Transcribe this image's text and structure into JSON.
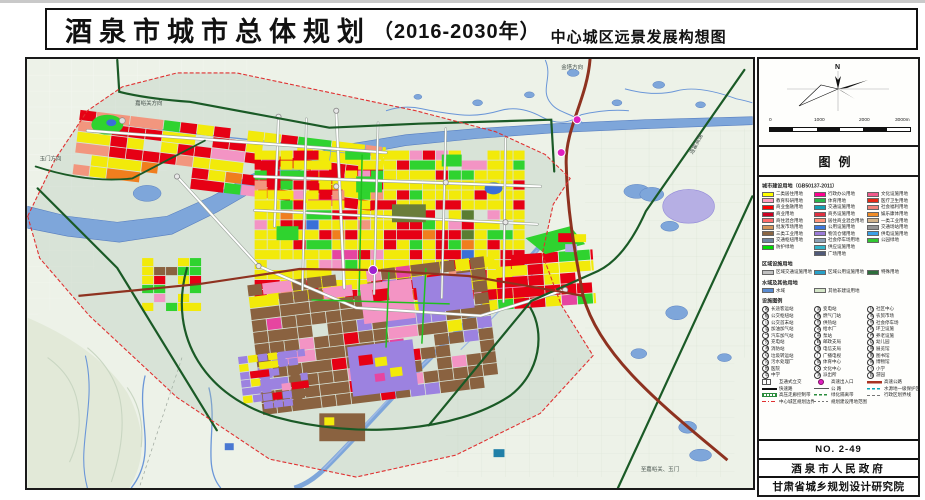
{
  "title": {
    "main": "酒泉市城市总体规划",
    "year": "（2016-2030年）",
    "subtitle": "中心城区远景发展构想图"
  },
  "sidebar": {
    "compass_north": "N",
    "scale": {
      "ticks": [
        "0",
        "1000",
        "2000",
        "3000m"
      ]
    },
    "legend_title": "图例",
    "landuse": {
      "header": "城市建设用地（GB50137-2011）",
      "columns": [
        [
          {
            "label": "二类居住用地",
            "color": "#ffff00"
          },
          {
            "label": "教育科研用地",
            "color": "#ff9dbe"
          },
          {
            "label": "商业金融用地",
            "color": "#ff0000"
          },
          {
            "label": "商业用地",
            "color": "#cc0022"
          },
          {
            "label": "商住混合用地",
            "color": "#ff6a6a"
          },
          {
            "label": "批发市场用地",
            "color": "#d2945a"
          },
          {
            "label": "三类工业用地",
            "color": "#8a6642"
          },
          {
            "label": "交通枢纽用地",
            "color": "#6e86a0"
          },
          {
            "label": "防护绿地",
            "color": "#00dc00"
          }
        ],
        [
          {
            "label": "行政办公用地",
            "color": "#ff0090"
          },
          {
            "label": "体育用地",
            "color": "#2ab54a"
          },
          {
            "label": "交通设施用地",
            "color": "#14a0b4"
          },
          {
            "label": "商务设施用地",
            "color": "#e03040"
          },
          {
            "label": "居住商业混合用地",
            "color": "#ff9478"
          },
          {
            "label": "公用设施用地",
            "color": "#3c78dc"
          },
          {
            "label": "物流仓储用地",
            "color": "#9b7bd8"
          },
          {
            "label": "社会停车场用地",
            "color": "#8ca0b4"
          },
          {
            "label": "供应设施用地",
            "color": "#32b4c8"
          },
          {
            "label": "广场用地",
            "color": "#505a78"
          }
        ],
        [
          {
            "label": "文化设施用地",
            "color": "#f05a8c"
          },
          {
            "label": "医疗卫生用地",
            "color": "#e62814"
          },
          {
            "label": "社会福利用地",
            "color": "#f08278"
          },
          {
            "label": "娱乐康体用地",
            "color": "#f08c28"
          },
          {
            "label": "一类工业用地",
            "color": "#d2b48c"
          },
          {
            "label": "交通场站用地",
            "color": "#969696"
          },
          {
            "label": "供电设施用地",
            "color": "#3ca0e6"
          },
          {
            "label": "公园绿地",
            "color": "#32c832"
          }
        ]
      ]
    },
    "regional": {
      "header": "区域设施用地",
      "items": [
        {
          "label": "区域交通设施用地",
          "color": "#c0c0c0"
        },
        {
          "label": "区域公用设施用地",
          "color": "#28a0c8"
        },
        {
          "label": "特殊用地",
          "color": "#2d6e3c"
        }
      ]
    },
    "water": {
      "header": "水域及其他用地",
      "items": [
        {
          "label": "水域",
          "color": "#5a8cd2"
        },
        {
          "label": "其他非建设用地",
          "color": "#d4e6c8"
        }
      ]
    },
    "facilities": {
      "header": "设施图例",
      "columns": [
        [
          {
            "icon": "客",
            "label": "长途客运站"
          },
          {
            "icon": "枢",
            "label": "公交枢纽站"
          },
          {
            "icon": "公",
            "label": "公交首末站"
          },
          {
            "icon": "油",
            "label": "加油加气站"
          },
          {
            "icon": "气",
            "label": "汽车加气站"
          },
          {
            "icon": "充",
            "label": "充电站"
          },
          {
            "icon": "消",
            "label": "消防站"
          },
          {
            "icon": "垃",
            "label": "垃圾转运站"
          },
          {
            "icon": "污",
            "label": "污水处理厂"
          },
          {
            "icon": "医",
            "label": "医院"
          },
          {
            "icon": "中",
            "label": "中学"
          }
        ],
        [
          {
            "icon": "变",
            "label": "变电站"
          },
          {
            "icon": "燃",
            "label": "燃气门站"
          },
          {
            "icon": "热",
            "label": "供热站"
          },
          {
            "icon": "水",
            "label": "给水厂"
          },
          {
            "icon": "泵",
            "label": "泵站"
          },
          {
            "icon": "邮",
            "label": "邮政支局"
          },
          {
            "icon": "信",
            "label": "电信支局"
          },
          {
            "icon": "广",
            "label": "广播电视"
          },
          {
            "icon": "体",
            "label": "体育中心"
          },
          {
            "icon": "文",
            "label": "文化中心"
          },
          {
            "icon": "派",
            "label": "派出所"
          }
        ],
        [
          {
            "icon": "社",
            "label": "社区中心"
          },
          {
            "icon": "市",
            "label": "农贸市场"
          },
          {
            "icon": "停",
            "label": "社会停车场"
          },
          {
            "icon": "环",
            "label": "环卫设施"
          },
          {
            "icon": "养",
            "label": "养老设施"
          },
          {
            "icon": "幼",
            "label": "幼儿园"
          },
          {
            "icon": "展",
            "label": "展览馆"
          },
          {
            "icon": "图",
            "label": "图书馆"
          },
          {
            "icon": "博",
            "label": "博物馆"
          },
          {
            "icon": "小",
            "label": "小学"
          },
          {
            "icon": "园",
            "label": "游园"
          }
        ]
      ]
    },
    "lines": {
      "rows": [
        [
          {
            "type": "bridge",
            "label": "互通式立交"
          },
          {
            "type": "dot",
            "label": "高速出入口"
          },
          {
            "type": "line-red",
            "label": "高速公路"
          }
        ],
        [
          {
            "type": "line-black",
            "label": "快速路"
          },
          {
            "type": "line-thin",
            "label": "公  路"
          },
          {
            "type": "dash-teal",
            "label": "水源地一级保护区"
          }
        ],
        [
          {
            "type": "hatch-green",
            "label": "高压走廊控制带"
          },
          {
            "type": "dash-green",
            "label": "绿化隔离带"
          },
          {
            "type": "dash-grey",
            "label": "行政区划界线"
          }
        ],
        [
          {
            "type": "dashdot-red",
            "label": "中心城区规划边界"
          },
          {
            "type": "dash-grey2",
            "label": "规划建设用地范围"
          }
        ]
      ]
    },
    "plate": {
      "no": "NO. 2-49",
      "owner": "酒泉市人民政府",
      "designer": "甘肃省城乡规划设计研究院"
    }
  },
  "map": {
    "labels": [
      "金塔方向",
      "嘉峪关方向",
      "玉门方向",
      "连霍高速",
      "至嘉峪关、玉门"
    ],
    "colors": {
      "Y": "#f2ea0a",
      "R": "#e60014",
      "G": "#2fd32f",
      "DG": "#5a7d32",
      "P": "#f394c4",
      "M": "#e645a0",
      "S": "#f2967e",
      "O": "#f07e1e",
      "B": "#3a6fd8",
      "T": "#12a0b4",
      "BR": "#8a6240",
      "PU": "#9c82e0",
      "LV": "#b4ace4",
      "TN": "#d2b48c",
      "GY": "#9aa4ae",
      "water": "#7ea6da",
      "water_edge": "#587fc0",
      "green_road": "#1a5a26",
      "highway": "#8e3220",
      "boundary": "#e03030",
      "interchange": "#e020c0"
    }
  }
}
